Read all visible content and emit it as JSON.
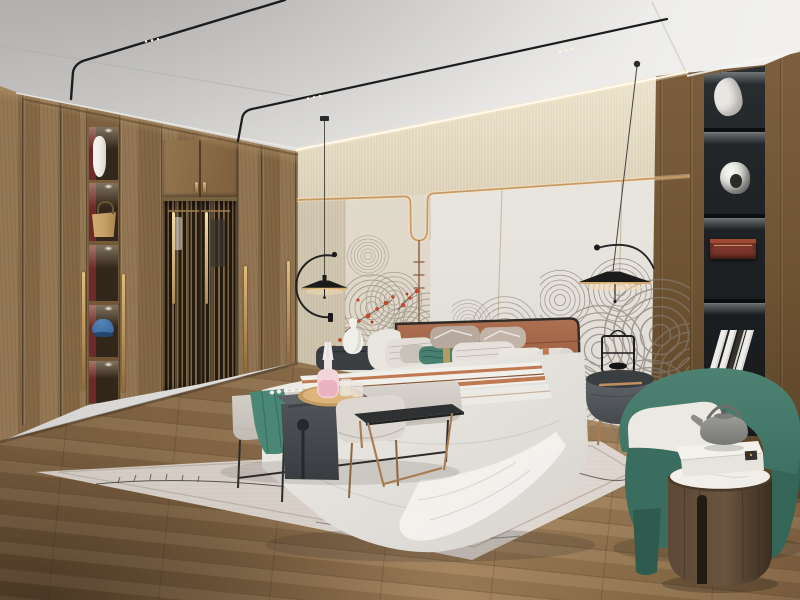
{
  "meta": {
    "description": "Photorealistic render of a modern Chinese-style bedroom with wood wardrobe, upholstered bed, pendant lamps and green armchair",
    "room_type": "bedroom",
    "image_kind": "interior-design-render"
  },
  "palette": {
    "ceilingA": "#c9c8c6",
    "ceilingB": "#f1f0ee",
    "rail": "#1d1d1d",
    "railDot": "#fff8dc",
    "cord": "#44443f",
    "lampBlack": "#1b1b1b",
    "band": "#d7cbb2",
    "bandGlow": "#f5edd6",
    "leftStrip": "#cabfa8",
    "panel": "#e7e3dd",
    "panelDark": "#d5d1cb",
    "seam": "#a8916f",
    "gold": "#c89a63",
    "goldGlow": "#ffe9c2",
    "artPanel": "#ded7c9",
    "artLine": "#8a7f74",
    "artRed": "#c2472b",
    "branch": "#5a4a3a",
    "wood": "#8a6c48",
    "woodLo": "#6b5233",
    "stile": "#4e3b25",
    "nicheBg": "#33261a",
    "nicheRed": "#6e2a28",
    "handle": "#d4ad6e",
    "handleLo": "#8f6a3a",
    "lattice": "#241a10",
    "slat": "#7b6749",
    "rwood": "#6f5433",
    "rwoodLo": "#523c22",
    "shelf": "#202427",
    "shelfWhite": "#e9e7e2",
    "shelfSilver": "#d9d8d4",
    "boxRed": "#7c352a",
    "boxRedHi": "#a04a34",
    "book": "#efede9",
    "bookDark": "#35322e",
    "capBlue": "#3e6ea3",
    "bag": "#c6a068",
    "vase": "#f1efe9",
    "floorA": "#7b5f40",
    "floorB": "#a1805a",
    "rug": "#d6cec6",
    "rugHi": "#e4dcd5",
    "rugLine": "#3c3833",
    "cone": "#6b4a33",
    "coneDark": "#3f2b1d",
    "coneHi": "#9a7350",
    "headboard": "#ad6f50",
    "headboardLo": "#8c5137",
    "frame": "#2e2a26",
    "duvet": "#efede8",
    "duvetLo": "#d7d4ce",
    "pillowWhite": "#e9e6e0",
    "pillowStripe": "#b9b4ab",
    "pillowTaupe": "#c9c2b8",
    "pillowMauve": "#b7a99e",
    "teal": "#47806f",
    "tealDark": "#2e5c4e",
    "goldBand": "#c8a05e",
    "terracotta": "#c07a52",
    "brownStripe": "#8a5a3f",
    "bench": "#d8d4cd",
    "benchLo": "#c0bcb4",
    "throw": "#4a8875",
    "throwDark": "#3a6f5f",
    "charcoal": "#515459",
    "charcoalLo": "#393c40",
    "tray": "#c49a63",
    "trayHi": "#dcb47c",
    "pink": "#eab2c0",
    "pinkHi": "#f3d4da",
    "glass": "#eee9e2",
    "stool": "#dcd8d1",
    "copper": "#a87c50",
    "blacktable": "#2e3032",
    "green": "#3e7163",
    "greenHi": "#4d8273",
    "greenLo": "#2e5b4e",
    "cushion": "#ece9e2",
    "drum": "#5c4835",
    "drumLo": "#3a2d20",
    "marble": "#efece6",
    "tea": "#9c9c98",
    "teaLo": "#777773",
    "ns": "#60646a",
    "nsLo": "#45484c",
    "nsTop": "#3b3e41",
    "nightstandDarkL": "#3c3f42"
  },
  "objects": [
    {
      "name": "ceiling-track-lights"
    },
    {
      "name": "wood-wardrobe"
    },
    {
      "name": "wardrobe-display-niches"
    },
    {
      "name": "white-vase-in-niche"
    },
    {
      "name": "tan-handbag-in-niche"
    },
    {
      "name": "blue-cap-in-niche"
    },
    {
      "name": "lattice-doors"
    },
    {
      "name": "beige-accent-wall-band"
    },
    {
      "name": "headboard-wall-panels"
    },
    {
      "name": "gold-led-wall-line"
    },
    {
      "name": "wave-pattern-wall-art"
    },
    {
      "name": "red-blossom-accents"
    },
    {
      "name": "pendant-lamp-left"
    },
    {
      "name": "pendant-lamp-right"
    },
    {
      "name": "upholstered-bed"
    },
    {
      "name": "terracotta-headboard"
    },
    {
      "name": "pillows"
    },
    {
      "name": "teal-lumbar-pillow"
    },
    {
      "name": "striped-runner"
    },
    {
      "name": "nightstand-left-with-vase"
    },
    {
      "name": "nightstand-right-with-lantern"
    },
    {
      "name": "foot-bench-with-teal-throw"
    },
    {
      "name": "charcoal-waterfall-table"
    },
    {
      "name": "wood-tray-with-pink-decanter"
    },
    {
      "name": "ottoman-stool"
    },
    {
      "name": "black-metal-side-table"
    },
    {
      "name": "area-rug-with-pinecones"
    },
    {
      "name": "green-barrel-armchair"
    },
    {
      "name": "drum-side-table-with-teapot"
    },
    {
      "name": "black-display-shelf-column"
    },
    {
      "name": "wood-plank-floor"
    }
  ]
}
